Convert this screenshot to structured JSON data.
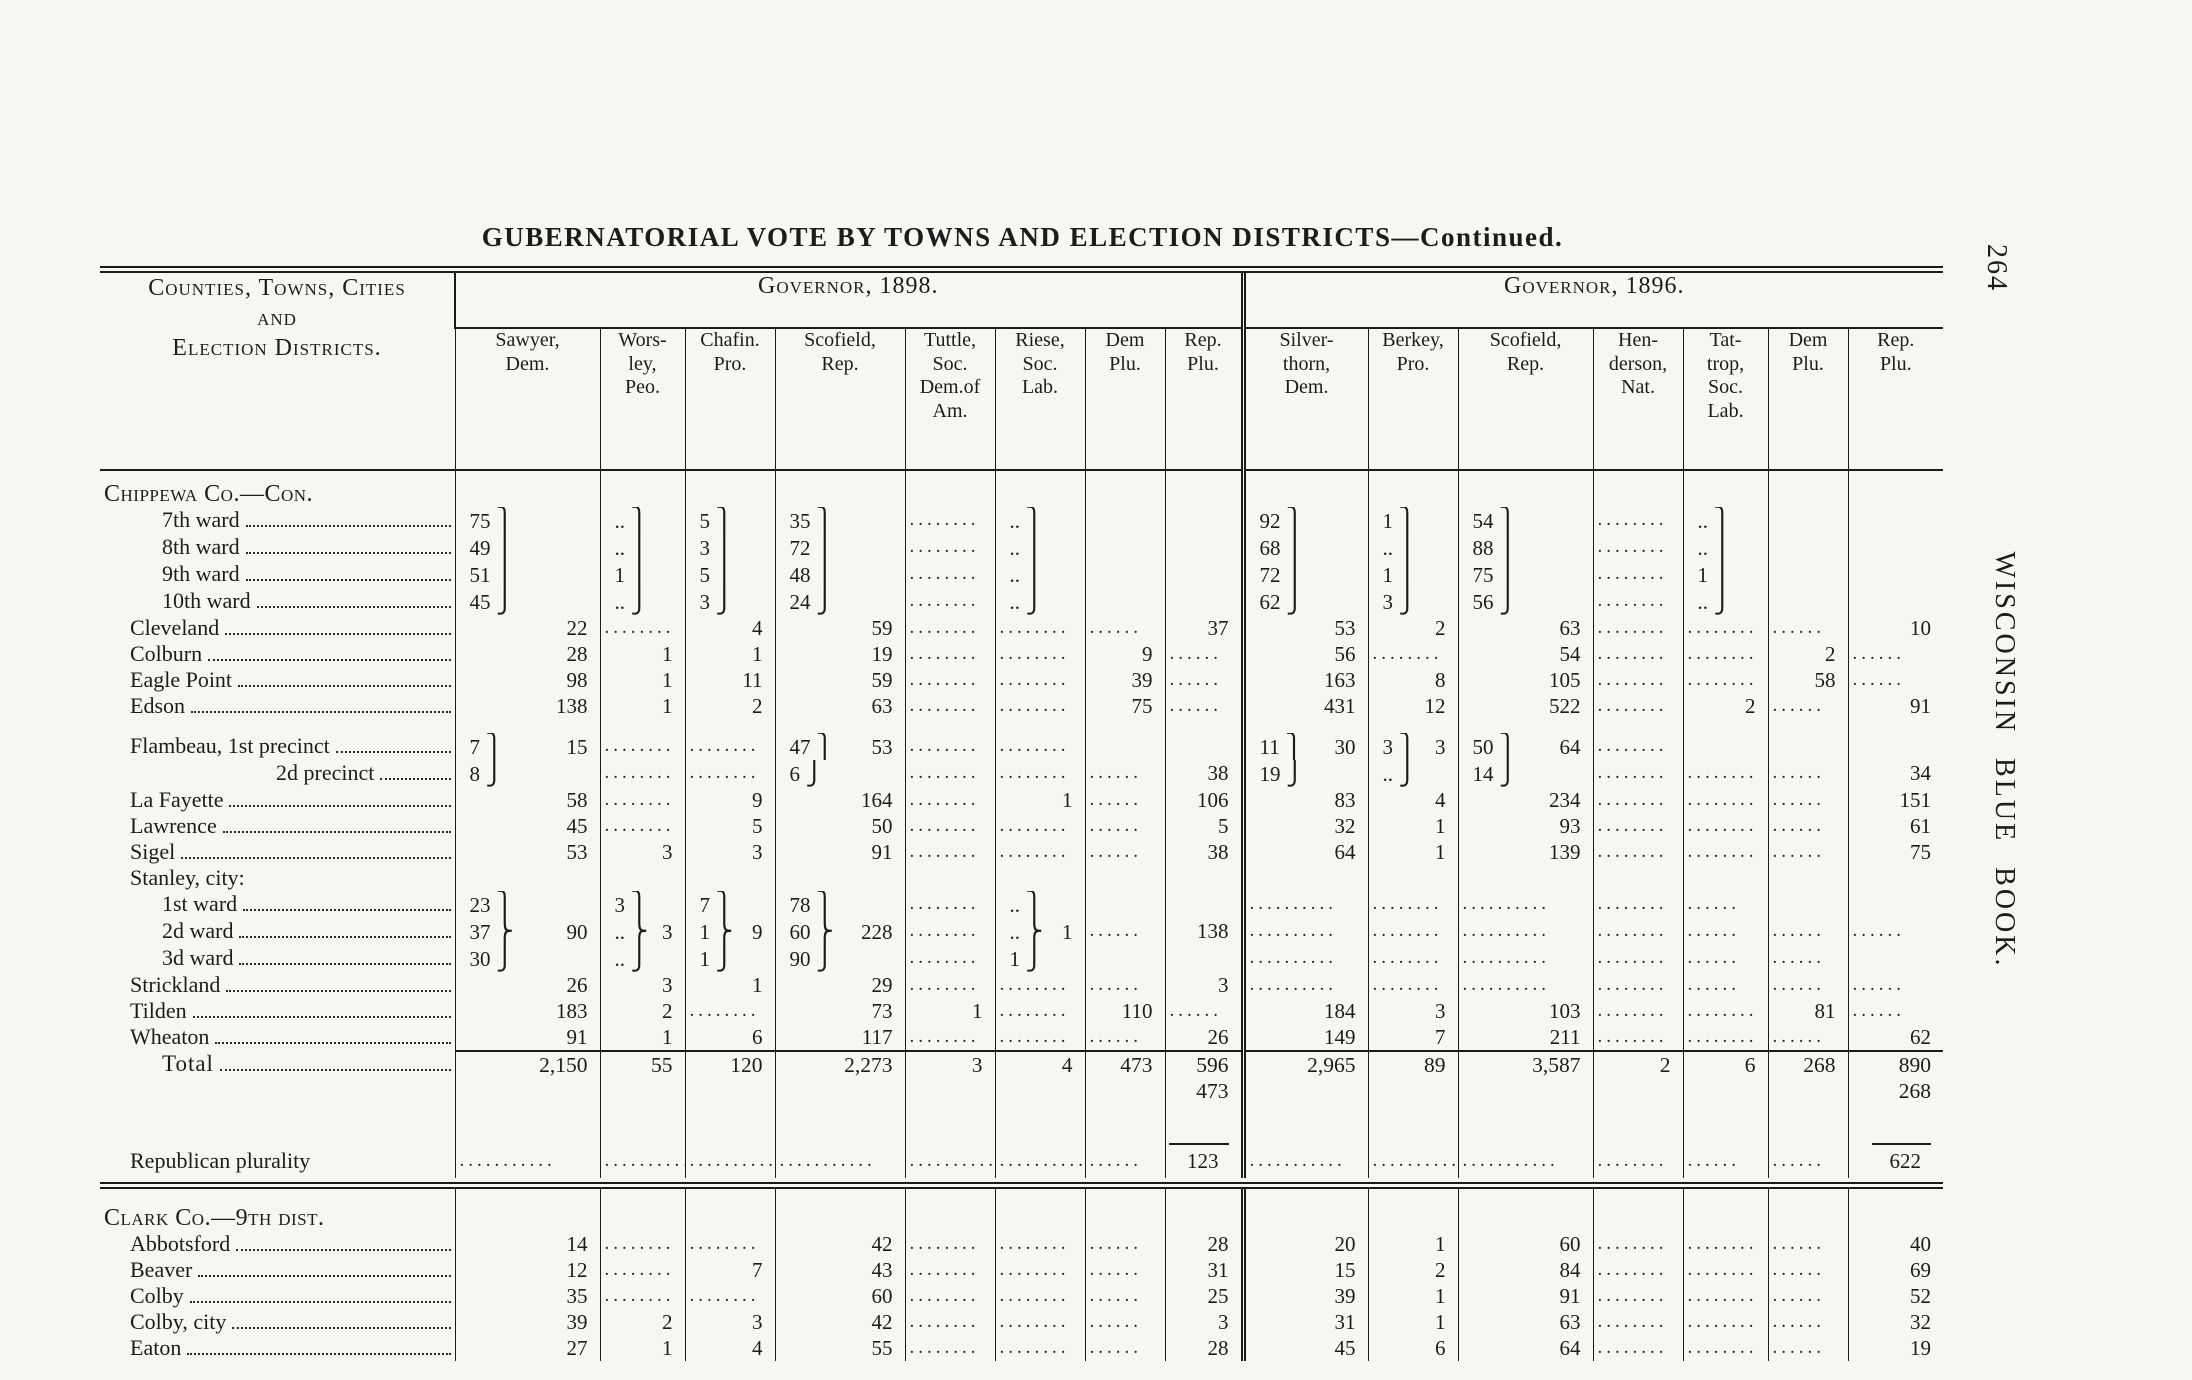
{
  "page": {
    "number": "264",
    "side_label": "WISCONSIN BLUE BOOK.",
    "title": "GUBERNATORIAL VOTE BY TOWNS AND ELECTION DISTRICTS—Continued."
  },
  "table": {
    "stub_header": "Counties, Towns, Cities\nand\nElection Districts.",
    "groups": [
      {
        "label": "Governor, 1898.",
        "columns": [
          "Sawyer,\nDem.",
          "Wors-\nley,\nPeo.",
          "Chafin.\nPro.",
          "Scofield,\nRep.",
          "Tuttle,\nSoc.\nDem.of\nAm.",
          "Riese,\nSoc.\nLab.",
          "Dem\nPlu.",
          "Rep.\nPlu."
        ]
      },
      {
        "label": "Governor, 1896.",
        "columns": [
          "Silver-\nthorn,\nDem.",
          "Berkey,\nPro.",
          "Scofield,\nRep.",
          "Hen-\nderson,\nNat.",
          "Tat-\ntrop,\nSoc.\nLab.",
          "Dem\nPlu.",
          "Rep.\nPlu."
        ]
      }
    ],
    "rows": [
      {
        "t": "spacer",
        "h": 10
      },
      {
        "t": "section",
        "label": "Chippewa Co.—Con.",
        "ind": 0,
        "leader": false
      },
      {
        "label": "7th ward",
        "ind": 2,
        "leader": true,
        "cells": [
          [
            "75 ⎫",
            ""
          ],
          [
            ".. ⎫",
            ""
          ],
          [
            "5 ⎫",
            ""
          ],
          [
            "35 ⎫",
            ""
          ],
          "........",
          [
            ".. ⎫",
            ""
          ],
          "",
          "",
          [
            "92 ⎫",
            ""
          ],
          [
            "1 ⎫",
            ""
          ],
          [
            "54 ⎫",
            ""
          ],
          "........",
          [
            ".. ⎫",
            ""
          ],
          "",
          ""
        ]
      },
      {
        "label": "8th ward",
        "ind": 2,
        "leader": true,
        "cells": [
          [
            "49 ⎪",
            ""
          ],
          [
            ".. ⎪",
            ""
          ],
          [
            "3 ⎪",
            ""
          ],
          [
            "72 ⎪",
            ""
          ],
          "........",
          [
            ".. ⎪",
            ""
          ],
          "",
          "",
          [
            "68 ⎪",
            ""
          ],
          [
            ".. ⎪",
            ""
          ],
          [
            "88 ⎪",
            ""
          ],
          "........",
          [
            ".. ⎪",
            ""
          ],
          "",
          ""
        ]
      },
      {
        "label": "9th ward",
        "ind": 2,
        "leader": true,
        "cells": [
          [
            "51 ⎪",
            ""
          ],
          [
            "1 ⎪",
            ""
          ],
          [
            "5 ⎪",
            ""
          ],
          [
            "48 ⎪",
            ""
          ],
          "........",
          [
            ".. ⎪",
            ""
          ],
          "",
          "",
          [
            "72 ⎪",
            ""
          ],
          [
            "1 ⎪",
            ""
          ],
          [
            "75 ⎪",
            ""
          ],
          "........",
          [
            "1 ⎪",
            ""
          ],
          "",
          ""
        ]
      },
      {
        "label": "10th ward",
        "ind": 2,
        "leader": true,
        "cells": [
          [
            "45 ⎭",
            ""
          ],
          [
            ".. ⎭",
            ""
          ],
          [
            "3 ⎭",
            ""
          ],
          [
            "24 ⎭",
            ""
          ],
          "........",
          [
            ".. ⎭",
            ""
          ],
          "",
          "",
          [
            "62 ⎭",
            ""
          ],
          [
            "3 ⎭",
            ""
          ],
          [
            "56 ⎭",
            ""
          ],
          "........",
          [
            ".. ⎭",
            ""
          ],
          "",
          ""
        ]
      },
      {
        "label": "Cleveland",
        "ind": 1,
        "leader": true,
        "cells": [
          "22",
          "........",
          "4",
          "59",
          "........",
          "........",
          "......",
          "37",
          "53",
          "2",
          "63",
          "........",
          "........",
          "......",
          "10"
        ]
      },
      {
        "label": "Colburn",
        "ind": 1,
        "leader": true,
        "cells": [
          "28",
          "1",
          "1",
          "19",
          "........",
          "........",
          "9",
          "......",
          "56",
          "........",
          "54",
          "........",
          "........",
          "2",
          "......"
        ]
      },
      {
        "label": "Eagle Point",
        "ind": 1,
        "leader": true,
        "cells": [
          "98",
          "1",
          "11",
          "59",
          "........",
          "........",
          "39",
          "......",
          "163",
          "8",
          "105",
          "........",
          "........",
          "58",
          "......"
        ]
      },
      {
        "label": "Edson",
        "ind": 1,
        "leader": true,
        "cells": [
          "138",
          "1",
          "2",
          "63",
          "........",
          "........",
          "75",
          "......",
          "431",
          "12",
          "522",
          "........",
          "2",
          "......",
          "91"
        ]
      },
      {
        "t": "spacer",
        "h": 14
      },
      {
        "label": "Flambeau, 1st precinct",
        "ind": 1,
        "leader": true,
        "cells": [
          [
            "7 ⎫",
            "15"
          ],
          "........",
          "........",
          [
            "47 ⎫",
            "53"
          ],
          "........",
          "........",
          "",
          "",
          [
            "11 ⎫",
            "30"
          ],
          [
            "3 ⎫",
            "3"
          ],
          [
            "50 ⎫",
            "64"
          ],
          "........",
          "",
          "",
          ""
        ]
      },
      {
        "label": "2d precinct",
        "ind": 3,
        "leader": true,
        "cells": [
          [
            "8 ⎭",
            ""
          ],
          "........",
          "........",
          [
            "6 ⎭",
            ""
          ],
          "........",
          "........",
          "......",
          "38",
          [
            "19 ⎭",
            ""
          ],
          [
            ".. ⎭",
            ""
          ],
          [
            "14 ⎭",
            ""
          ],
          "........",
          "........",
          "......",
          "34"
        ]
      },
      {
        "label": "La Fayette",
        "ind": 1,
        "leader": true,
        "cells": [
          "58",
          "........",
          "9",
          "164",
          "........",
          "1",
          "......",
          "106",
          "83",
          "4",
          "234",
          "........",
          "........",
          "......",
          "151"
        ]
      },
      {
        "label": "Lawrence",
        "ind": 1,
        "leader": true,
        "cells": [
          "45",
          "........",
          "5",
          "50",
          "........",
          "........",
          "......",
          "5",
          "32",
          "1",
          "93",
          "........",
          "........",
          "......",
          "61"
        ]
      },
      {
        "label": "Sigel",
        "ind": 1,
        "leader": true,
        "cells": [
          "53",
          "3",
          "3",
          "91",
          "........",
          "........",
          "......",
          "38",
          "64",
          "1",
          "139",
          "........",
          "........",
          "......",
          "75"
        ]
      },
      {
        "label": "Stanley, city:",
        "ind": 1,
        "leader": false,
        "cells": [
          "",
          "",
          "",
          "",
          "",
          "",
          "",
          "",
          "",
          "",
          "",
          "",
          "",
          "",
          ""
        ]
      },
      {
        "label": "1st ward",
        "ind": 2,
        "leader": true,
        "cells": [
          [
            "23 ⎫",
            ""
          ],
          [
            "3 ⎫",
            ""
          ],
          [
            "7 ⎫",
            ""
          ],
          [
            "78 ⎫",
            ""
          ],
          "........",
          [
            ".. ⎫",
            ""
          ],
          "",
          "",
          "..........",
          "........",
          "..........",
          "........",
          "......",
          "",
          ""
        ]
      },
      {
        "label": "2d ward",
        "ind": 2,
        "leader": true,
        "cells": [
          [
            "37 ⎬",
            "90"
          ],
          [
            ".. ⎬",
            "3"
          ],
          [
            "1 ⎬",
            "9"
          ],
          [
            "60 ⎬",
            "228"
          ],
          "........",
          [
            ".. ⎬",
            "1"
          ],
          "......",
          "138",
          "..........",
          "........",
          "..........",
          "........",
          "......",
          "......",
          "......"
        ]
      },
      {
        "label": "3d ward",
        "ind": 2,
        "leader": true,
        "cells": [
          [
            "30 ⎭",
            ""
          ],
          [
            ".. ⎭",
            ""
          ],
          [
            "1 ⎭",
            ""
          ],
          [
            "90 ⎭",
            ""
          ],
          "........",
          [
            "1 ⎭",
            ""
          ],
          "",
          "",
          "..........",
          "........",
          "..........",
          "........",
          "......",
          "......",
          ""
        ]
      },
      {
        "label": "Strickland",
        "ind": 1,
        "leader": true,
        "cells": [
          "26",
          "3",
          "1",
          "29",
          "........",
          "........",
          "......",
          "3",
          "..........",
          "........",
          "..........",
          "........",
          "......",
          "......",
          "......"
        ]
      },
      {
        "label": "Tilden",
        "ind": 1,
        "leader": true,
        "cells": [
          "183",
          "2",
          "........",
          "73",
          "1",
          "........",
          "110",
          "......",
          "184",
          "3",
          "103",
          "........",
          "........",
          "81",
          "......"
        ]
      },
      {
        "label": "Wheaton",
        "ind": 1,
        "leader": true,
        "cells": [
          "91",
          "1",
          "6",
          "117",
          "........",
          "........",
          "......",
          "26",
          "149",
          "7",
          "211",
          "........",
          "........",
          "......",
          "62"
        ]
      },
      {
        "t": "total",
        "label": "Total",
        "ind": 2,
        "leader": true,
        "cells": [
          "2,150",
          "55",
          "120",
          "2,273",
          "3",
          "4",
          "473",
          "596\n473",
          "2,965",
          "89",
          "3,587",
          "2",
          "6",
          "268",
          "890\n268"
        ]
      },
      {
        "t": "plural",
        "label": "Republican plurality",
        "ind": 1,
        "leader": false,
        "cells": [
          "...........",
          "..........",
          "..........",
          "...........",
          "..........",
          "..........",
          "......",
          "123",
          "...........",
          "..........",
          "...........",
          "........",
          "......",
          "......",
          "622"
        ]
      },
      {
        "t": "drule"
      },
      {
        "t": "spacer",
        "h": 16
      },
      {
        "t": "section",
        "label": "Clark Co.—9th dist.",
        "ind": 0,
        "leader": false
      },
      {
        "label": "Abbotsford",
        "ind": 1,
        "leader": true,
        "cells": [
          "14",
          "........",
          "........",
          "42",
          "........",
          "........",
          "......",
          "28",
          "20",
          "1",
          "60",
          "........",
          "........",
          "......",
          "40"
        ]
      },
      {
        "label": "Beaver",
        "ind": 1,
        "leader": true,
        "cells": [
          "12",
          "........",
          "7",
          "43",
          "........",
          "........",
          "......",
          "31",
          "15",
          "2",
          "84",
          "........",
          "........",
          "......",
          "69"
        ]
      },
      {
        "label": "Colby",
        "ind": 1,
        "leader": true,
        "cells": [
          "35",
          "........",
          "........",
          "60",
          "........",
          "........",
          "......",
          "25",
          "39",
          "1",
          "91",
          "........",
          "........",
          "......",
          "52"
        ]
      },
      {
        "label": "Colby, city",
        "ind": 1,
        "leader": true,
        "cells": [
          "39",
          "2",
          "3",
          "42",
          "........",
          "........",
          "......",
          "3",
          "31",
          "1",
          "63",
          "........",
          "........",
          "......",
          "32"
        ]
      },
      {
        "label": "Eaton",
        "ind": 1,
        "leader": true,
        "cells": [
          "27",
          "1",
          "4",
          "55",
          "........",
          "........",
          "......",
          "28",
          "45",
          "6",
          "64",
          "........",
          "........",
          "......",
          "19"
        ]
      }
    ]
  }
}
